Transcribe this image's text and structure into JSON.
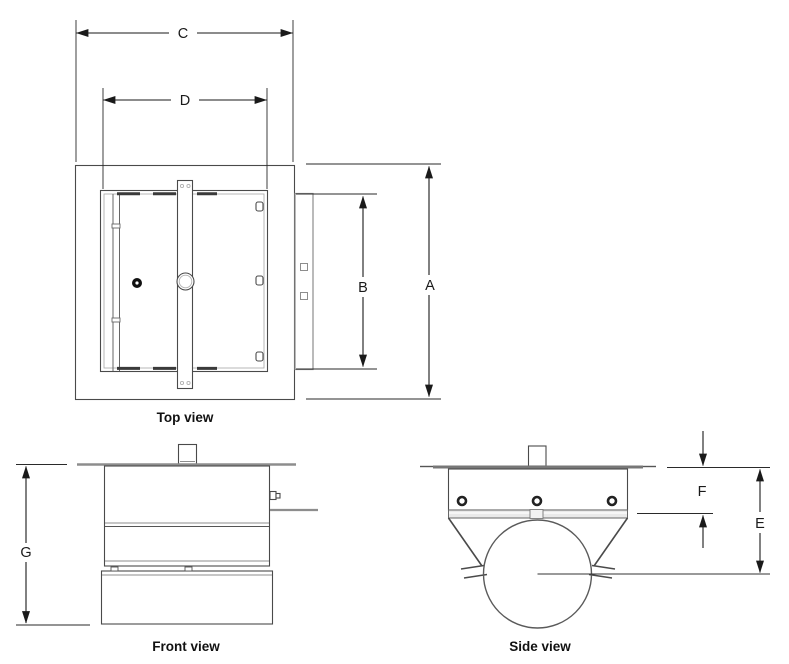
{
  "views": [
    {
      "label": "Top view"
    },
    {
      "label": "Front view"
    },
    {
      "label": "Side view"
    }
  ],
  "dim_labels": {
    "A": "A",
    "B": "B",
    "C": "C",
    "D": "D",
    "E": "E",
    "F": "F",
    "G": "G"
  },
  "colors": {
    "background": "#ffffff",
    "line": "#4a4a4a",
    "grey_line": "#8d8d8d",
    "dimension": "#1a1a1a"
  }
}
